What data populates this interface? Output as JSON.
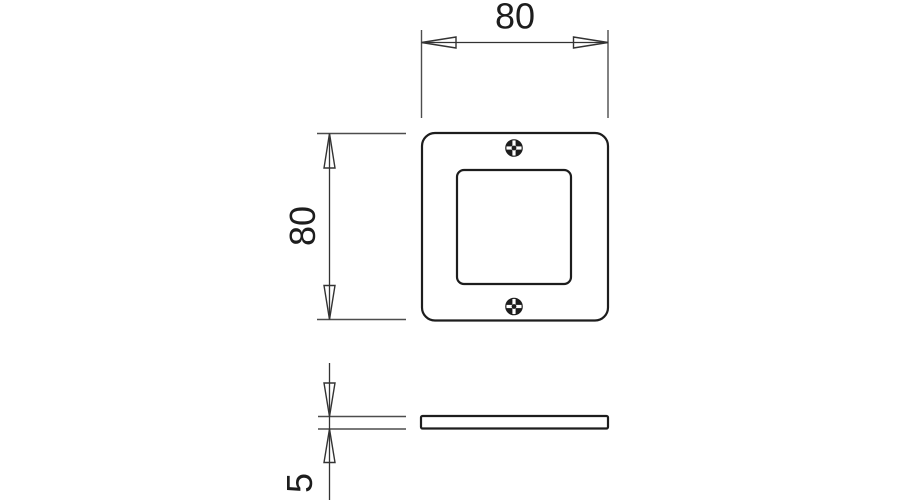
{
  "drawing": {
    "colors": {
      "bg": "#ffffff",
      "line": "#1d1d1d",
      "dim": "#333333",
      "ext": "#4d4d4d"
    },
    "dimensions": {
      "width": {
        "value": "80"
      },
      "height": {
        "value": "80"
      },
      "thickness": {
        "value": "5"
      }
    },
    "icons": {
      "screw": "phillips-screw-icon"
    }
  }
}
